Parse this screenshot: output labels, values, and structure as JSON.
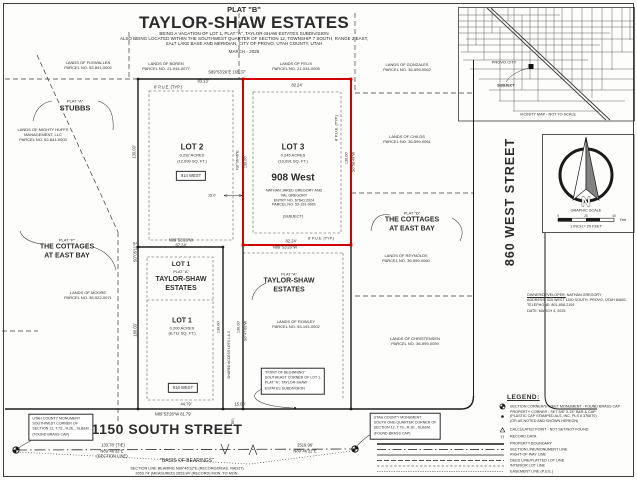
{
  "title_block": {
    "plat": "PLAT \"B\"",
    "name": "TAYLOR-SHAW ESTATES",
    "sub1": "BEING A VACATION OF LOT 1, PLAT \"A\", TAYLOR-SHAW ESTATES SUBDIVISION",
    "sub2": "ALSO BEING LOCATED WITHIN THE SOUTHWEST QUARTER OF SECTION 12, TOWNSHIP 7 SOUTH, RANGE 2 EAST,",
    "sub3": "SALT LAKE BASE AND MERIDIAN, CITY OF PROVO, UTAH COUNTY, UTAH",
    "date": "MARCH - 2025"
  },
  "vicinity": {
    "city": "PROVO CITY",
    "subject": "SUBJECT",
    "caption": "VICINITY MAP  -  NOT TO SCALE"
  },
  "streets": {
    "south": "1150 SOUTH STREET",
    "west": "860 WEST STREET"
  },
  "north": {
    "n": "N",
    "graphic_scale": "GRAPHIC SCALE",
    "scale_ratio": "1 INCH = 20 FEET",
    "tick0": "0",
    "tick20": "20",
    "tick40": "40",
    "unit": "Feet"
  },
  "owner": {
    "label": "OWNER/DEVELOPER:",
    "name": "NATHAN GREGORY",
    "address": "ADDRESS:  916 WEST 1150 SOUTH, PROVO, UTAH 84601",
    "phone": "TELEPHONE:  801-808-2104",
    "date": "DATE: MARCH 4, 2025"
  },
  "legend": {
    "title": "LEGEND:",
    "record_symbol": "(  )",
    "items": [
      {
        "sym": "monument",
        "lines": [
          "SECTION CORNER/STREET MONUMENT  -  FOUND BRASS CAP"
        ]
      },
      {
        "sym": "dot",
        "lines": [
          "PROPERTY CORNER - SET 5/8\" X 24\" BAR & CAP",
          "(PLASTIC CAP STAMPED ALS, INC. PLS # 376070)",
          "(OR AS NOTED AND SHOWN HEREON)"
        ]
      },
      {
        "sym": "triangle",
        "lines": [
          "CALCULATED POINT  -  NOT SET/NOT FOUND"
        ]
      },
      {
        "sym": "parens",
        "lines": [
          "RECORD DATA"
        ]
      },
      {
        "sym": "line-property",
        "lines": [
          "PROPERTY BOUNDARY"
        ]
      },
      {
        "sym": "line-section",
        "lines": [
          "SECTION LINE/MONUMENT LINE"
        ]
      },
      {
        "sym": "line-row",
        "lines": [
          "RIGHT-OF-WAY LINE"
        ]
      },
      {
        "sym": "line-deed",
        "lines": [
          "DEED LINE/PLATTED LOT LINE"
        ]
      },
      {
        "sym": "line-interior",
        "lines": [
          "INTERIOR LOT LINE"
        ]
      },
      {
        "sym": "line-easement",
        "lines": [
          "EASEMENT LINE (P.U.E.)"
        ]
      }
    ]
  },
  "map": {
    "groups": [
      {
        "name": "parcel-flewallen",
        "x": 88,
        "y": 65,
        "lines": [
          {
            "t": "LANDS OF FLEWALLEN"
          },
          {
            "t": "PARCEL NO. 52-841-0002"
          }
        ]
      },
      {
        "name": "parcel-boren",
        "x": 166,
        "y": 65.5,
        "lines": [
          {
            "t": "LANDS OF BOREN"
          },
          {
            "t": "PARCEL NO. 21-044-0077"
          }
        ]
      },
      {
        "name": "parcel-felix",
        "x": 296,
        "y": 65.5,
        "lines": [
          {
            "t": "LANDS OF FELIX"
          },
          {
            "t": "PARCEL NO. 21-044-0005"
          }
        ]
      },
      {
        "name": "parcel-gonzales",
        "x": 407,
        "y": 66.5,
        "lines": [
          {
            "t": "LANDS OF GONZALES"
          },
          {
            "t": "PARCEL NO. 36-599-0062"
          }
        ]
      },
      {
        "name": "parcel-mighty-huffs",
        "x": 43,
        "y": 135,
        "lines": [
          {
            "t": "LANDS OF MIGHTY HUFFS"
          },
          {
            "t": "MANAGEMENT, LLC"
          },
          {
            "t": "PARCEL NO. 52-841-0003"
          }
        ]
      },
      {
        "name": "parcel-childs",
        "x": 407,
        "y": 139,
        "lines": [
          {
            "t": "LANDS OF CHILDS"
          },
          {
            "t": "PARCEL NO. 36-599-0061"
          }
        ]
      },
      {
        "name": "parcel-reynolds",
        "x": 406,
        "y": 258,
        "lines": [
          {
            "t": "LANDS OF REYNOLDS"
          },
          {
            "t": "PARCEL NO. 36-599-0060"
          }
        ]
      },
      {
        "name": "parcel-moore",
        "x": 88,
        "y": 294.5,
        "lines": [
          {
            "t": "LANDS OF MOORE"
          },
          {
            "t": "PARCEL NO. 36-522-0071"
          }
        ]
      },
      {
        "name": "parcel-rowley",
        "x": 296,
        "y": 323.5,
        "lines": [
          {
            "t": "LANDS OF ROWLEY"
          },
          {
            "t": "PARCEL NO. 53-191-0002"
          }
        ]
      },
      {
        "name": "parcel-christensen",
        "x": 415,
        "y": 341,
        "lines": [
          {
            "t": "LANDS OF CHRISTENSEN"
          },
          {
            "t": "PARCEL NO. 36-599-0059"
          }
        ]
      },
      {
        "name": "plat-a-stubbs",
        "x": 75,
        "y": 105.5,
        "lines": [
          {
            "t": "PLAT \"A\""
          },
          {
            "t": "STUBBS",
            "fs": 7.5,
            "b": 1
          }
        ]
      },
      {
        "name": "plat-p-cottages",
        "x": 67,
        "y": 249,
        "lines": [
          {
            "t": "PLAT \"P\""
          },
          {
            "t": "THE COTTAGES",
            "fs": 7,
            "b": 1
          },
          {
            "t": "AT EAST BAY",
            "fs": 7,
            "b": 1
          }
        ]
      },
      {
        "name": "plat-d-cottages",
        "x": 412,
        "y": 222,
        "lines": [
          {
            "t": "PLAT \"D\""
          },
          {
            "t": "THE COTTAGES",
            "fs": 7,
            "b": 1
          },
          {
            "t": "AT EAST BAY",
            "fs": 7,
            "b": 1
          }
        ]
      },
      {
        "name": "lot2-card",
        "x": 192,
        "y": 153,
        "lines": [
          {
            "t": "LOT 2",
            "fs": 8,
            "b": 1
          },
          {
            "t": "0.292 ACRES"
          },
          {
            "t": "(12,699 SQ. FT.)"
          }
        ]
      },
      {
        "name": "lot3-card",
        "x": 293,
        "y": 153,
        "lines": [
          {
            "t": "LOT 3",
            "fs": 8,
            "b": 1
          },
          {
            "t": "0.245 ACRES"
          },
          {
            "t": "(10,691 SQ. FT.)"
          }
        ]
      },
      {
        "name": "lot3-address",
        "x": 293,
        "y": 178,
        "lines": [
          {
            "t": "908 West",
            "fs": 10,
            "b": 1
          }
        ]
      },
      {
        "name": "lot3-owner",
        "x": 294,
        "y": 198,
        "lines": [
          {
            "t": "NATHAN JARED GREGORY AND",
            "fs": 3.7
          },
          {
            "t": "VAL GREGORY",
            "fs": 3.7
          },
          {
            "t": "ENTRY NO. 67641:2024",
            "fs": 3.7
          },
          {
            "t": "PARCEL NO. 53-191-0001",
            "fs": 3.7
          }
        ]
      },
      {
        "name": "lot3-subject",
        "x": 293,
        "y": 215.5,
        "lines": [
          {
            "t": "(SUBJECT)",
            "fs": 3.9
          }
        ]
      },
      {
        "name": "lot1-plat-a-label",
        "x": 181,
        "y": 277,
        "lines": [
          {
            "t": "LOT 1",
            "fs": 6.5,
            "b": 1
          },
          {
            "t": "PLAT \"A\"",
            "fs": 3.9
          },
          {
            "t": "TAYLOR-SHAW",
            "fs": 7,
            "b": 1
          },
          {
            "t": "ESTATES",
            "fs": 7,
            "b": 1
          }
        ]
      },
      {
        "name": "plat-a-center-label",
        "x": 289,
        "y": 283,
        "lines": [
          {
            "t": "PLAT \"A\"",
            "fs": 3.9
          },
          {
            "t": "TAYLOR-SHAW",
            "fs": 7,
            "b": 1
          },
          {
            "t": "ESTATES",
            "fs": 7,
            "b": 1
          }
        ]
      },
      {
        "name": "lot1-card",
        "x": 182,
        "y": 326,
        "lines": [
          {
            "t": "LOT 1",
            "fs": 7,
            "b": 1
          },
          {
            "t": "0.200 ACRES"
          },
          {
            "t": "(8,711 SQ. FT.)"
          }
        ]
      }
    ],
    "labels": [
      {
        "t": "S89°53'26\"E   165.37'",
        "x": 227,
        "y": 71.5
      },
      {
        "t": "83.13'",
        "x": 203,
        "y": 80.5
      },
      {
        "t": "8' P.U.E. (TYP.)",
        "x": 168,
        "y": 87
      },
      {
        "t": "82.24'",
        "x": 297,
        "y": 85
      },
      {
        "t": "130.00'",
        "x": 134,
        "y": 152,
        "r": -90
      },
      {
        "t": "N0°06'46\"E",
        "x": 238,
        "y": 160,
        "r": -90,
        "fs": 3.8
      },
      {
        "t": "130.00'",
        "x": 246,
        "y": 162,
        "r": -90,
        "fs": 3.8
      },
      {
        "t": "8' P.U.E. (TYP.)",
        "x": 337,
        "y": 128,
        "r": -90,
        "fs": 3.8
      },
      {
        "t": "130.00'",
        "x": 346.5,
        "y": 158,
        "r": -90,
        "fs": 3.8
      },
      {
        "t": "S0°58'49\"W",
        "x": 354,
        "y": 162,
        "r": -90,
        "fs": 3.8
      },
      {
        "t": "15.0'",
        "x": 212,
        "y": 195.5,
        "fs": 3.8
      },
      {
        "t": "82.24'",
        "x": 291,
        "y": 241
      },
      {
        "t": "N89°53'26\"W",
        "x": 285,
        "y": 246.5
      },
      {
        "t": "8' P.U.E. (TYP.)",
        "x": 321,
        "y": 238.5,
        "fs": 3.8
      },
      {
        "t": "N89°53'26\"W",
        "x": 181,
        "y": 239.5
      },
      {
        "t": "67.24'",
        "x": 181,
        "y": 244.5
      },
      {
        "t": "S0°05'11\"E",
        "x": 135,
        "y": 252,
        "r": -90
      },
      {
        "t": "180.00'",
        "x": 135,
        "y": 330,
        "r": -90
      },
      {
        "t": "130.00'",
        "x": 219,
        "y": 327,
        "r": -90,
        "fs": 3.8
      },
      {
        "t": "130.00'",
        "x": 239,
        "y": 327,
        "r": -90,
        "fs": 3.8
      },
      {
        "t": "S0°47'00\"W",
        "x": 246,
        "y": 331,
        "r": -90,
        "fs": 3.8
      },
      {
        "t": "SHARED ACCESS LOTS 1 & 3",
        "x": 229,
        "y": 355,
        "r": -90,
        "fs": 3.4
      },
      {
        "t": "44.79'",
        "x": 186,
        "y": 404
      },
      {
        "t": "N89°53'26\"W   81.79'",
        "x": 173,
        "y": 413.5
      },
      {
        "t": "15.00'",
        "x": 240,
        "y": 403.5
      },
      {
        "t": "(TIE)",
        "x": 233,
        "y": 422,
        "r": -90,
        "fs": 3.4
      },
      {
        "t": "133.78' (TIE)",
        "x": 113,
        "y": 444.5
      },
      {
        "t": "N89°46'32\"E",
        "x": 112,
        "y": 450.5
      },
      {
        "t": "(SECTION LINE)",
        "x": 112,
        "y": 456
      },
      {
        "t": "2519.96'",
        "x": 305,
        "y": 444.5
      },
      {
        "t": "N89°46'32\"E",
        "x": 305,
        "y": 450.5
      },
      {
        "t": "\"BASIS OF BEARINGS\"",
        "x": 187,
        "y": 461,
        "fs": 5
      },
      {
        "t": "SECTION LINE BEARING N89°46'32\"E (RECORD/MEAS. NAD27)",
        "x": 187,
        "y": 468.5,
        "fs": 3.8
      },
      {
        "t": "2653.74' (MEASURED)   2653.84' (RECORD)   MON. TO MON.",
        "x": 187,
        "y": 473.5,
        "fs": 3.8
      }
    ],
    "boxes": [
      {
        "name": "address-914",
        "x": 191,
        "y": 175.5,
        "center": true,
        "lines": [
          "914 WEST"
        ]
      },
      {
        "name": "address-916",
        "x": 183,
        "y": 388,
        "center": true,
        "lines": [
          "916 WEST"
        ]
      },
      {
        "name": "point-of-beginning-note",
        "x": 293,
        "y": 381,
        "lines": [
          "\"POINT OF BEGINNING\"",
          "SOUTHEAST CORNER OF LOT 1,",
          "PLAT \"A\", TAYLOR-SHAW",
          "ESTATES SUBDIVISION"
        ]
      },
      {
        "name": "monument-sw-note",
        "x": 61,
        "y": 427,
        "lines": [
          "UTAH COUNTY MONUMENT",
          "SOUTHWEST CORNER OF",
          "SECTION 12, T.7S., R.2E., SLB&M.",
          "(FOUND BRASS CAP)"
        ]
      },
      {
        "name": "monument-quarter-note",
        "x": 405,
        "y": 426,
        "lines": [
          "UTAH COUNTY MONUMENT",
          "SOUTH ONE-QUARTER CORNER OF",
          "SECTION 12, T.7S., R.2E., SLB&M.",
          "(FOUND BRASS CAP)"
        ]
      }
    ]
  }
}
